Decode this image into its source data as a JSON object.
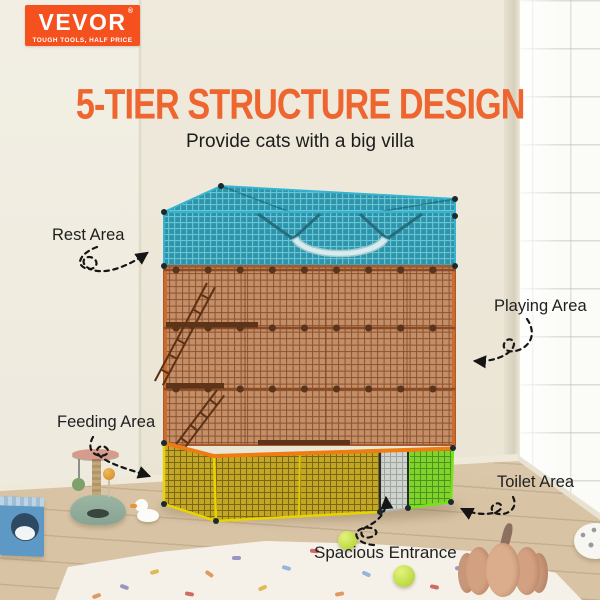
{
  "brand": {
    "name": "VEVOR",
    "registered": "®",
    "tagline": "TOUGH TOOLS, HALF PRICE",
    "color": "#F4511E"
  },
  "header": {
    "title": "5-TIER STRUCTURE DESIGN",
    "subtitle": "Provide cats with a big villa",
    "title_color": "#EF652F"
  },
  "callouts": {
    "rest": {
      "label": "Rest Area"
    },
    "playing": {
      "label": "Playing Area"
    },
    "feeding": {
      "label": "Feeding Area"
    },
    "toilet": {
      "label": "Toilet Area"
    },
    "entrance": {
      "label": "Spacious Entrance"
    }
  },
  "cage": {
    "tiers": [
      {
        "name": "rest-area-top",
        "color": "#2F93A9",
        "frame": "#35B5D1"
      },
      {
        "name": "playing-area-middle",
        "color": "#C48E66",
        "frame": "#CF6A2D"
      },
      {
        "name": "feeding-area-bottom-left",
        "color": "#C3A625",
        "frame": "#E8D400"
      },
      {
        "name": "toilet-area-bottom-right",
        "color": "#7FD32C",
        "frame": "#72E418"
      }
    ],
    "entrance_panel_color": "#CFD4CE",
    "accent_rail_color": "#EE7C12"
  },
  "scene": {
    "props": [
      "cat-house",
      "scratching-post",
      "rubber-duck",
      "tennis-ball",
      "tennis-ball",
      "plush-pumpkin",
      "spotted-plush",
      "polka-dot-rug",
      "glass-block-window"
    ]
  }
}
